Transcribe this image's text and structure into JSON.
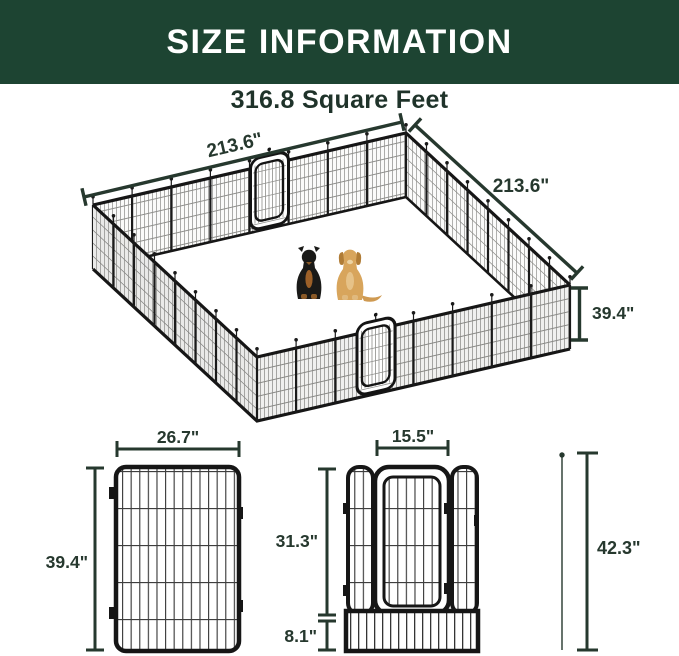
{
  "header": {
    "title": "SIZE INFORMATION"
  },
  "pen": {
    "area_label": "316.8 Square Feet",
    "side_top_left": "213.6\"",
    "side_top_right": "213.6\"",
    "wall_height": "39.4\"",
    "dog_icons": [
      "rottweiler-dog",
      "golden-retriever-dog"
    ]
  },
  "panel": {
    "width": "26.7\"",
    "height": "39.4\""
  },
  "door_panel": {
    "door_width": "15.5\"",
    "door_height": "31.3\"",
    "base_height": "8.1\"",
    "total_height": "42.3\""
  },
  "colors": {
    "banner_green": "#1d4432",
    "dimension": "#26382e",
    "metal_frame": "#161616"
  }
}
